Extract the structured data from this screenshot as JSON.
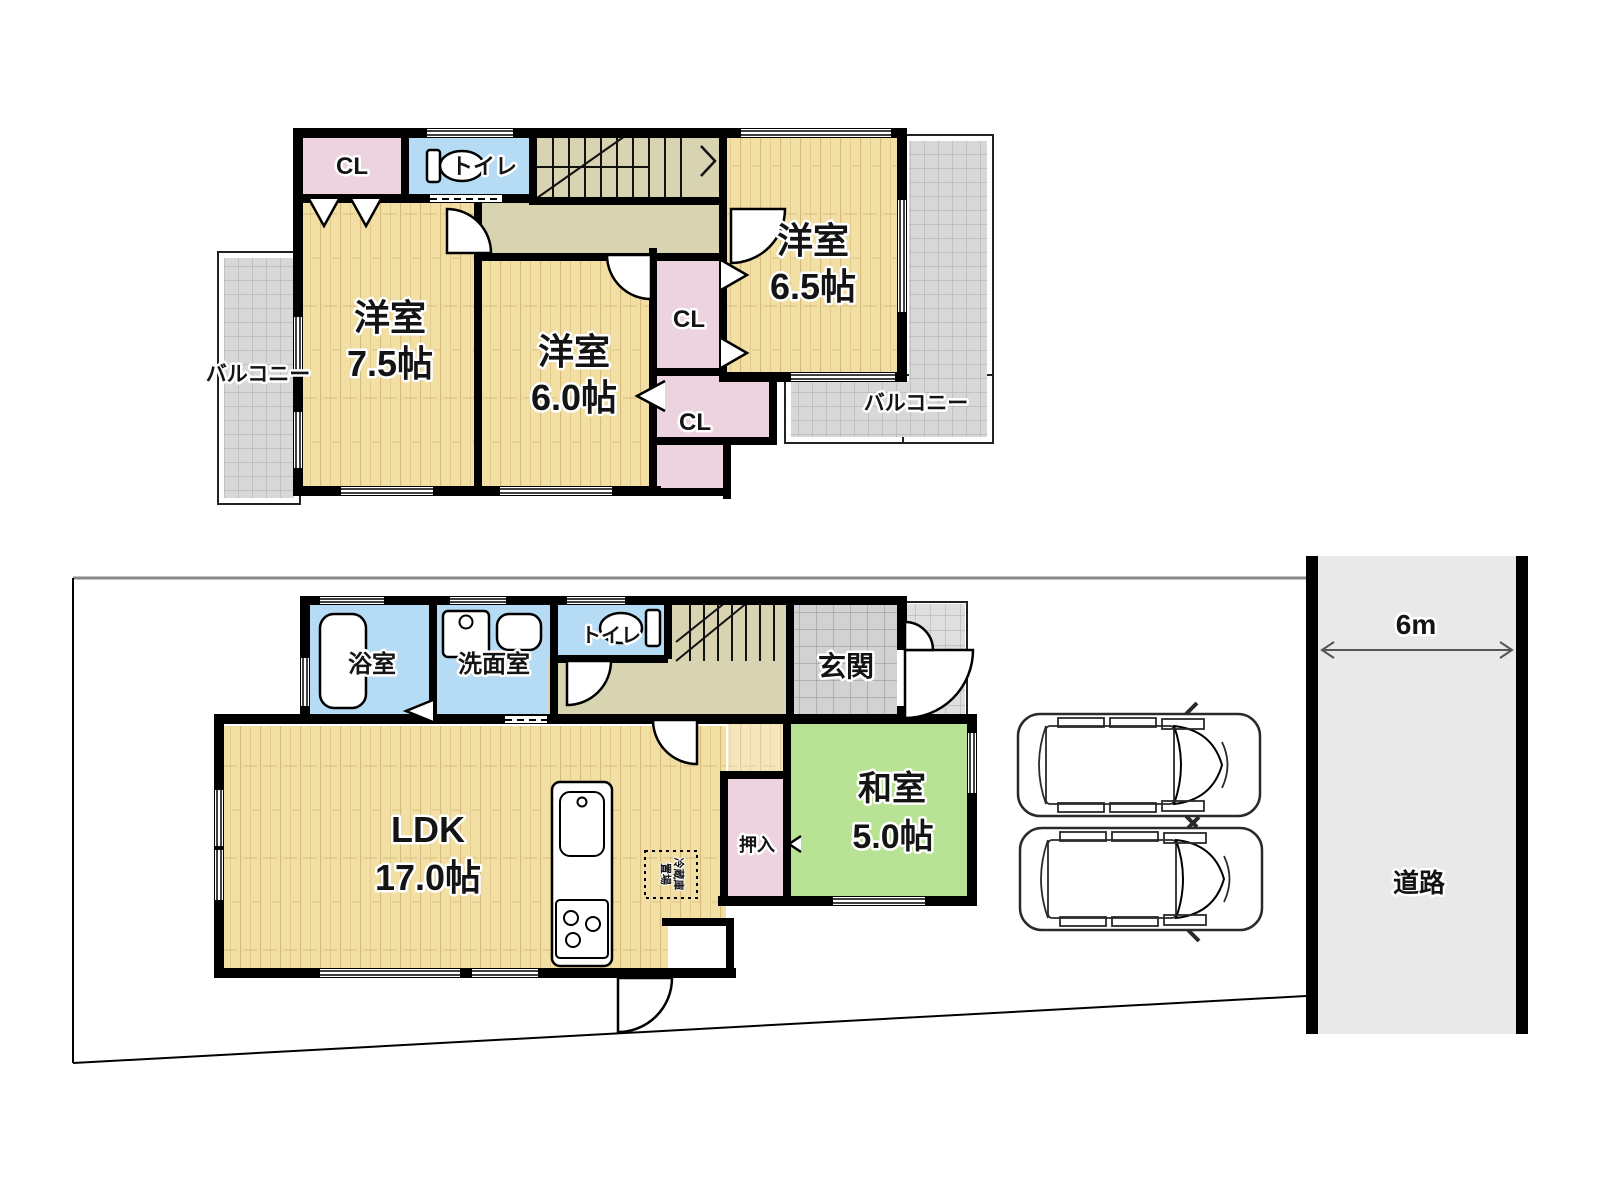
{
  "floor2": {
    "closet_top": "CL",
    "toilet": "トイレ",
    "room75": {
      "name": "洋室",
      "size": "7.5帖"
    },
    "room60": {
      "name": "洋室",
      "size": "6.0帖"
    },
    "room65": {
      "name": "洋室",
      "size": "6.5帖"
    },
    "closet_mid": "CL",
    "closet_bottom": "CL",
    "balcony_left": "バルコニー",
    "balcony_right": "バルコニー"
  },
  "floor1": {
    "bath": "浴室",
    "washroom": "洗面室",
    "toilet": "トイレ",
    "entrance": "玄関",
    "ldk": {
      "name": "LDK",
      "size": "17.0帖"
    },
    "refrigerator": {
      "line1": "冷蔵庫",
      "line2": "置場"
    },
    "oshiire": "押入",
    "washitsu": {
      "name": "和室",
      "size": "5.0帖"
    }
  },
  "site": {
    "road_width": "6m",
    "road": "道路"
  },
  "colors": {
    "wood": "#f1dfa4",
    "pink": "#ecd3df",
    "blue": "#b5dcf4",
    "khaki": "#d8d3b0",
    "green": "#b9e394",
    "road": "#e9e9e9",
    "wall": "#000000"
  }
}
